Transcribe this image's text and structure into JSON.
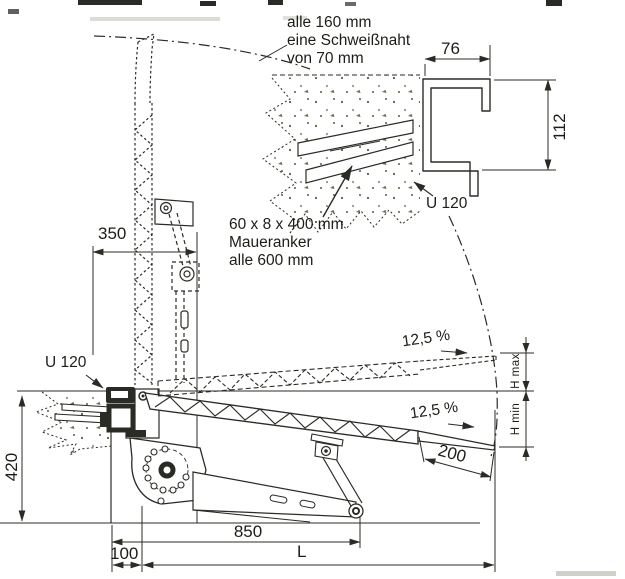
{
  "colors": {
    "line": "#2b2b26",
    "text": "#1d1d18",
    "background": "#ffffff"
  },
  "detail_view": {
    "weld_note_line1": "alle 160 mm",
    "weld_note_line2": "eine Schweißnaht",
    "weld_note_line3": "von 70 mm",
    "flange_width": "76",
    "profile_height": "112",
    "profile_label": "U 120",
    "anchor_note_line1": "60 x 8 x 400 mm",
    "anchor_note_line2": "Maueranker",
    "anchor_note_line3": "alle 600 mm"
  },
  "side_view": {
    "rail_offset": "350",
    "profile_label": "U 120",
    "pit_depth": "420",
    "slope_raised": "12,5 %",
    "slope_lowered": "12,5 %",
    "height_max_label": "H max",
    "height_min_label": "H min",
    "lip_length": "200",
    "frame_length": "850",
    "wall_offset": "100",
    "total_length_label": "L"
  }
}
